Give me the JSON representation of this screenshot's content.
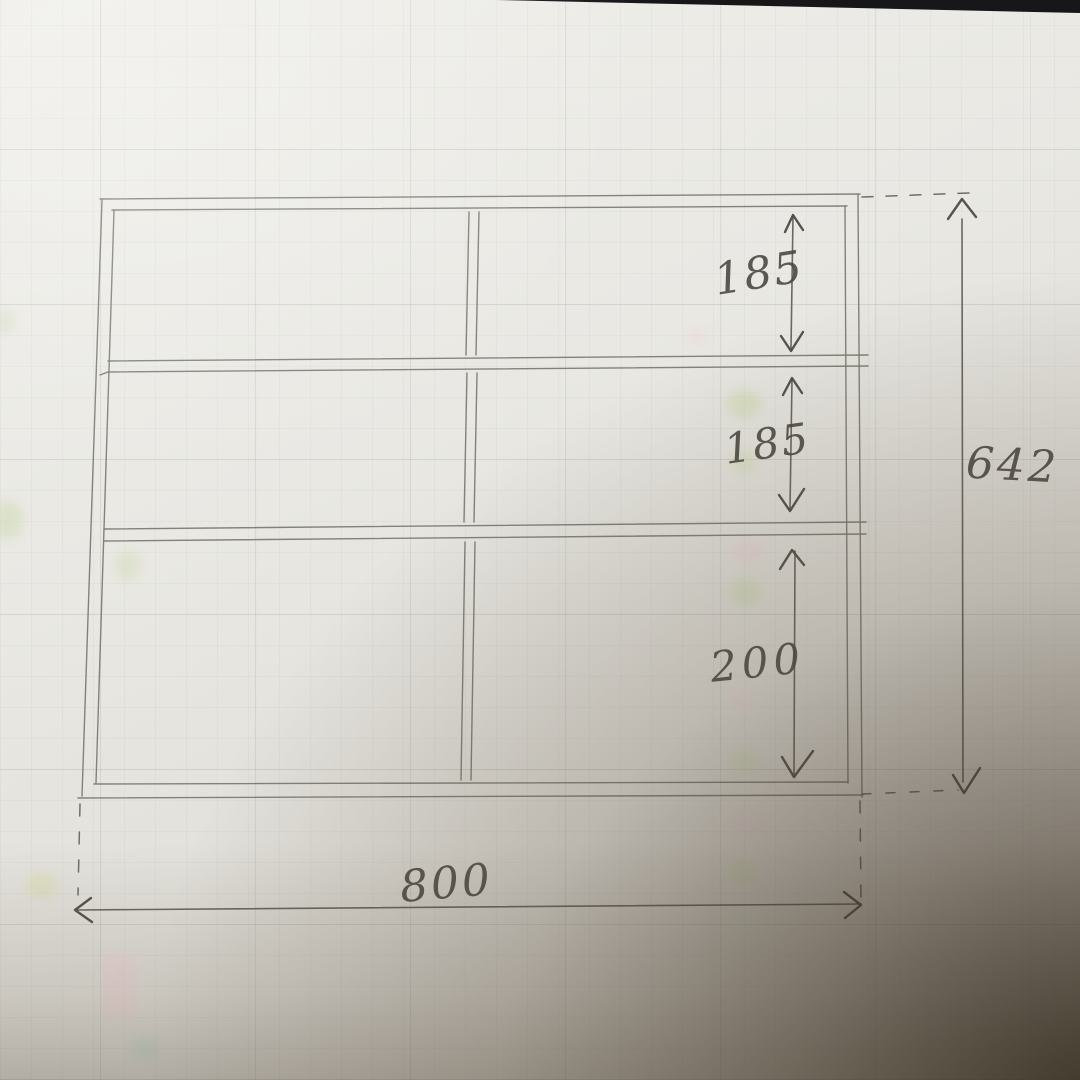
{
  "sketch": {
    "dimensions": {
      "top_section_height": "185",
      "middle_section_height": "185",
      "bottom_section_height": "200",
      "overall_height": "642",
      "overall_width": "800"
    }
  }
}
